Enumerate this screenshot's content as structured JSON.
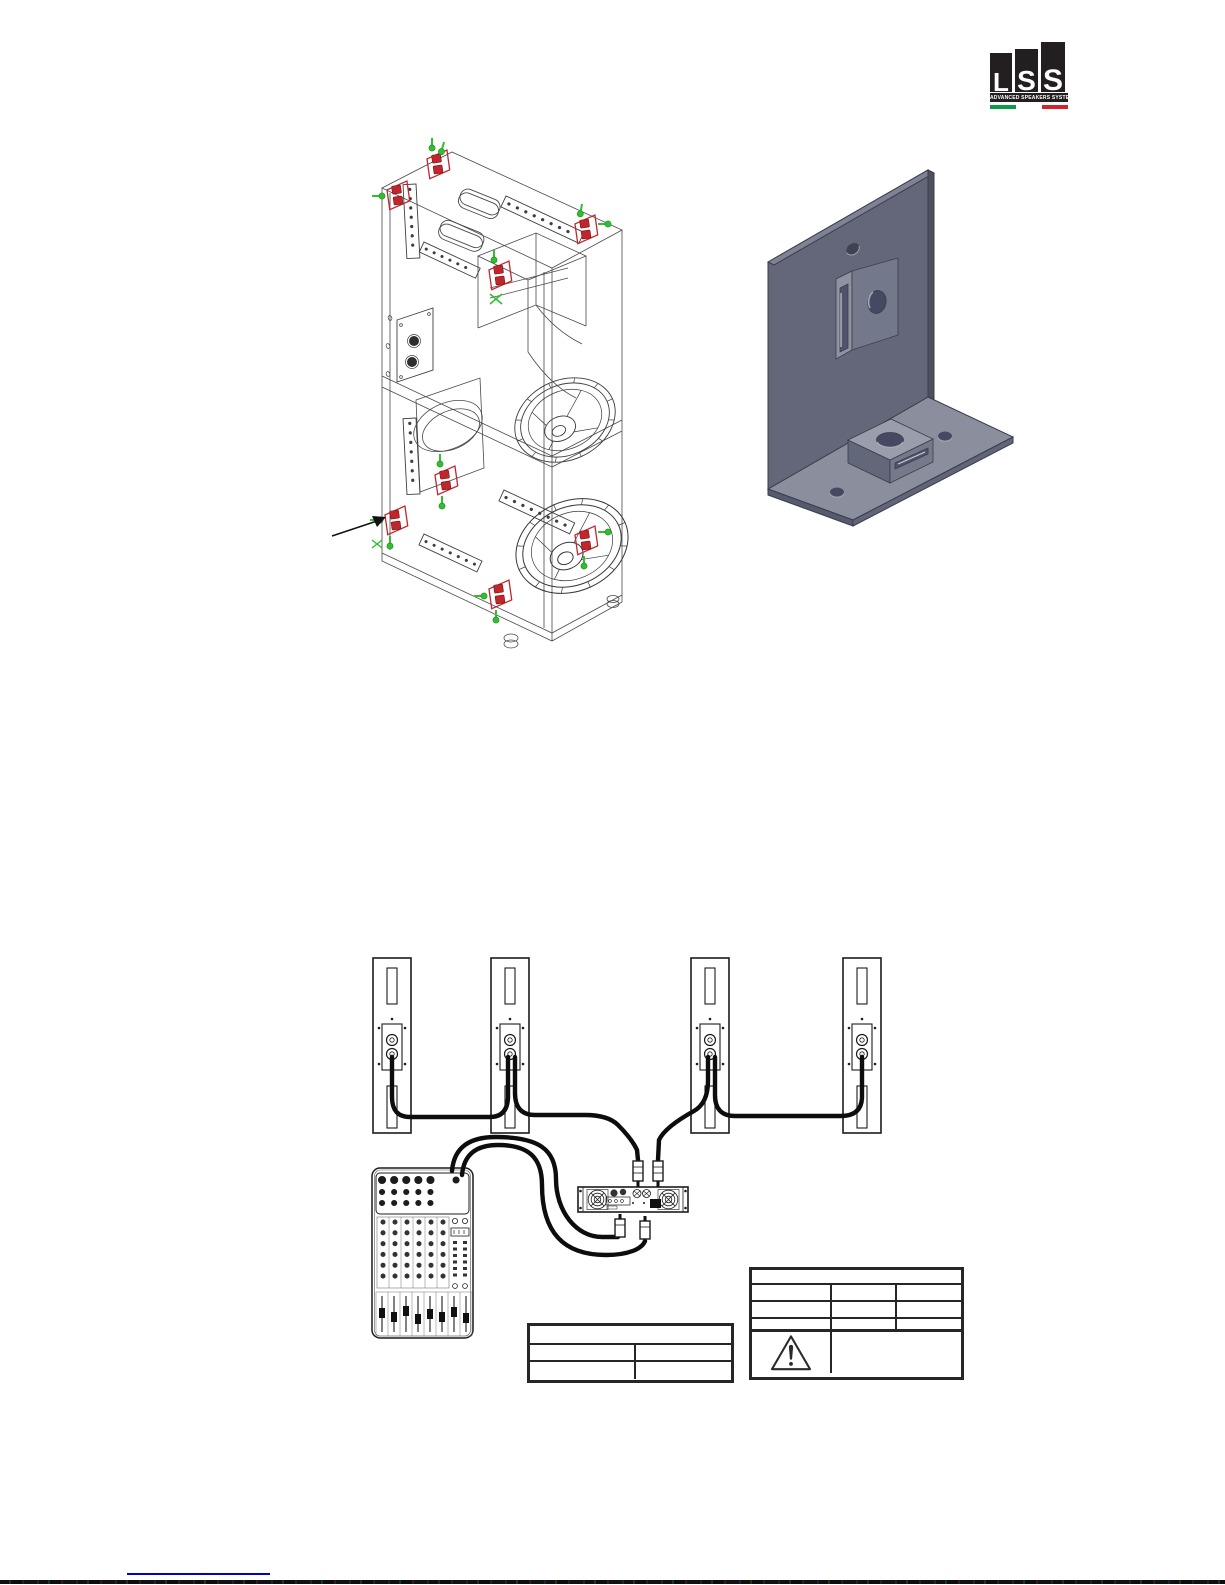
{
  "logo": {
    "letters": [
      "L",
      "S",
      "S"
    ],
    "tagline": "ADVANCED SPEAKERS SYSTEMS",
    "block_color": "#231f20",
    "flag_green": "#0a9a4a",
    "flag_white": "#ffffff",
    "flag_red": "#d5232e"
  },
  "figures": {
    "cabinet_wireframe": {
      "mount_points": 8,
      "bracket_color": "#c0272d",
      "screw_color": "#2fbf2f",
      "line_color": "#4a4a4a"
    },
    "l_bracket": {
      "metal_color": "#636779",
      "base_color": "#8b8e9d"
    },
    "wiring_diagram": {
      "speaker_count": 4,
      "cable_color": "#0d0d0d",
      "devices": [
        "speaker",
        "speaker",
        "speaker",
        "speaker",
        "amplifier",
        "mixer"
      ]
    }
  },
  "tables": {
    "left": {
      "header": "",
      "rows": [
        [
          "",
          ""
        ],
        [
          "",
          ""
        ]
      ]
    },
    "right": {
      "header": "",
      "rows": [
        [
          "",
          "",
          ""
        ],
        [
          "",
          "",
          ""
        ],
        [
          "",
          "",
          ""
        ]
      ],
      "warning_note": ""
    }
  },
  "footer": {
    "link_text": "",
    "link_color": "#0000cc"
  }
}
